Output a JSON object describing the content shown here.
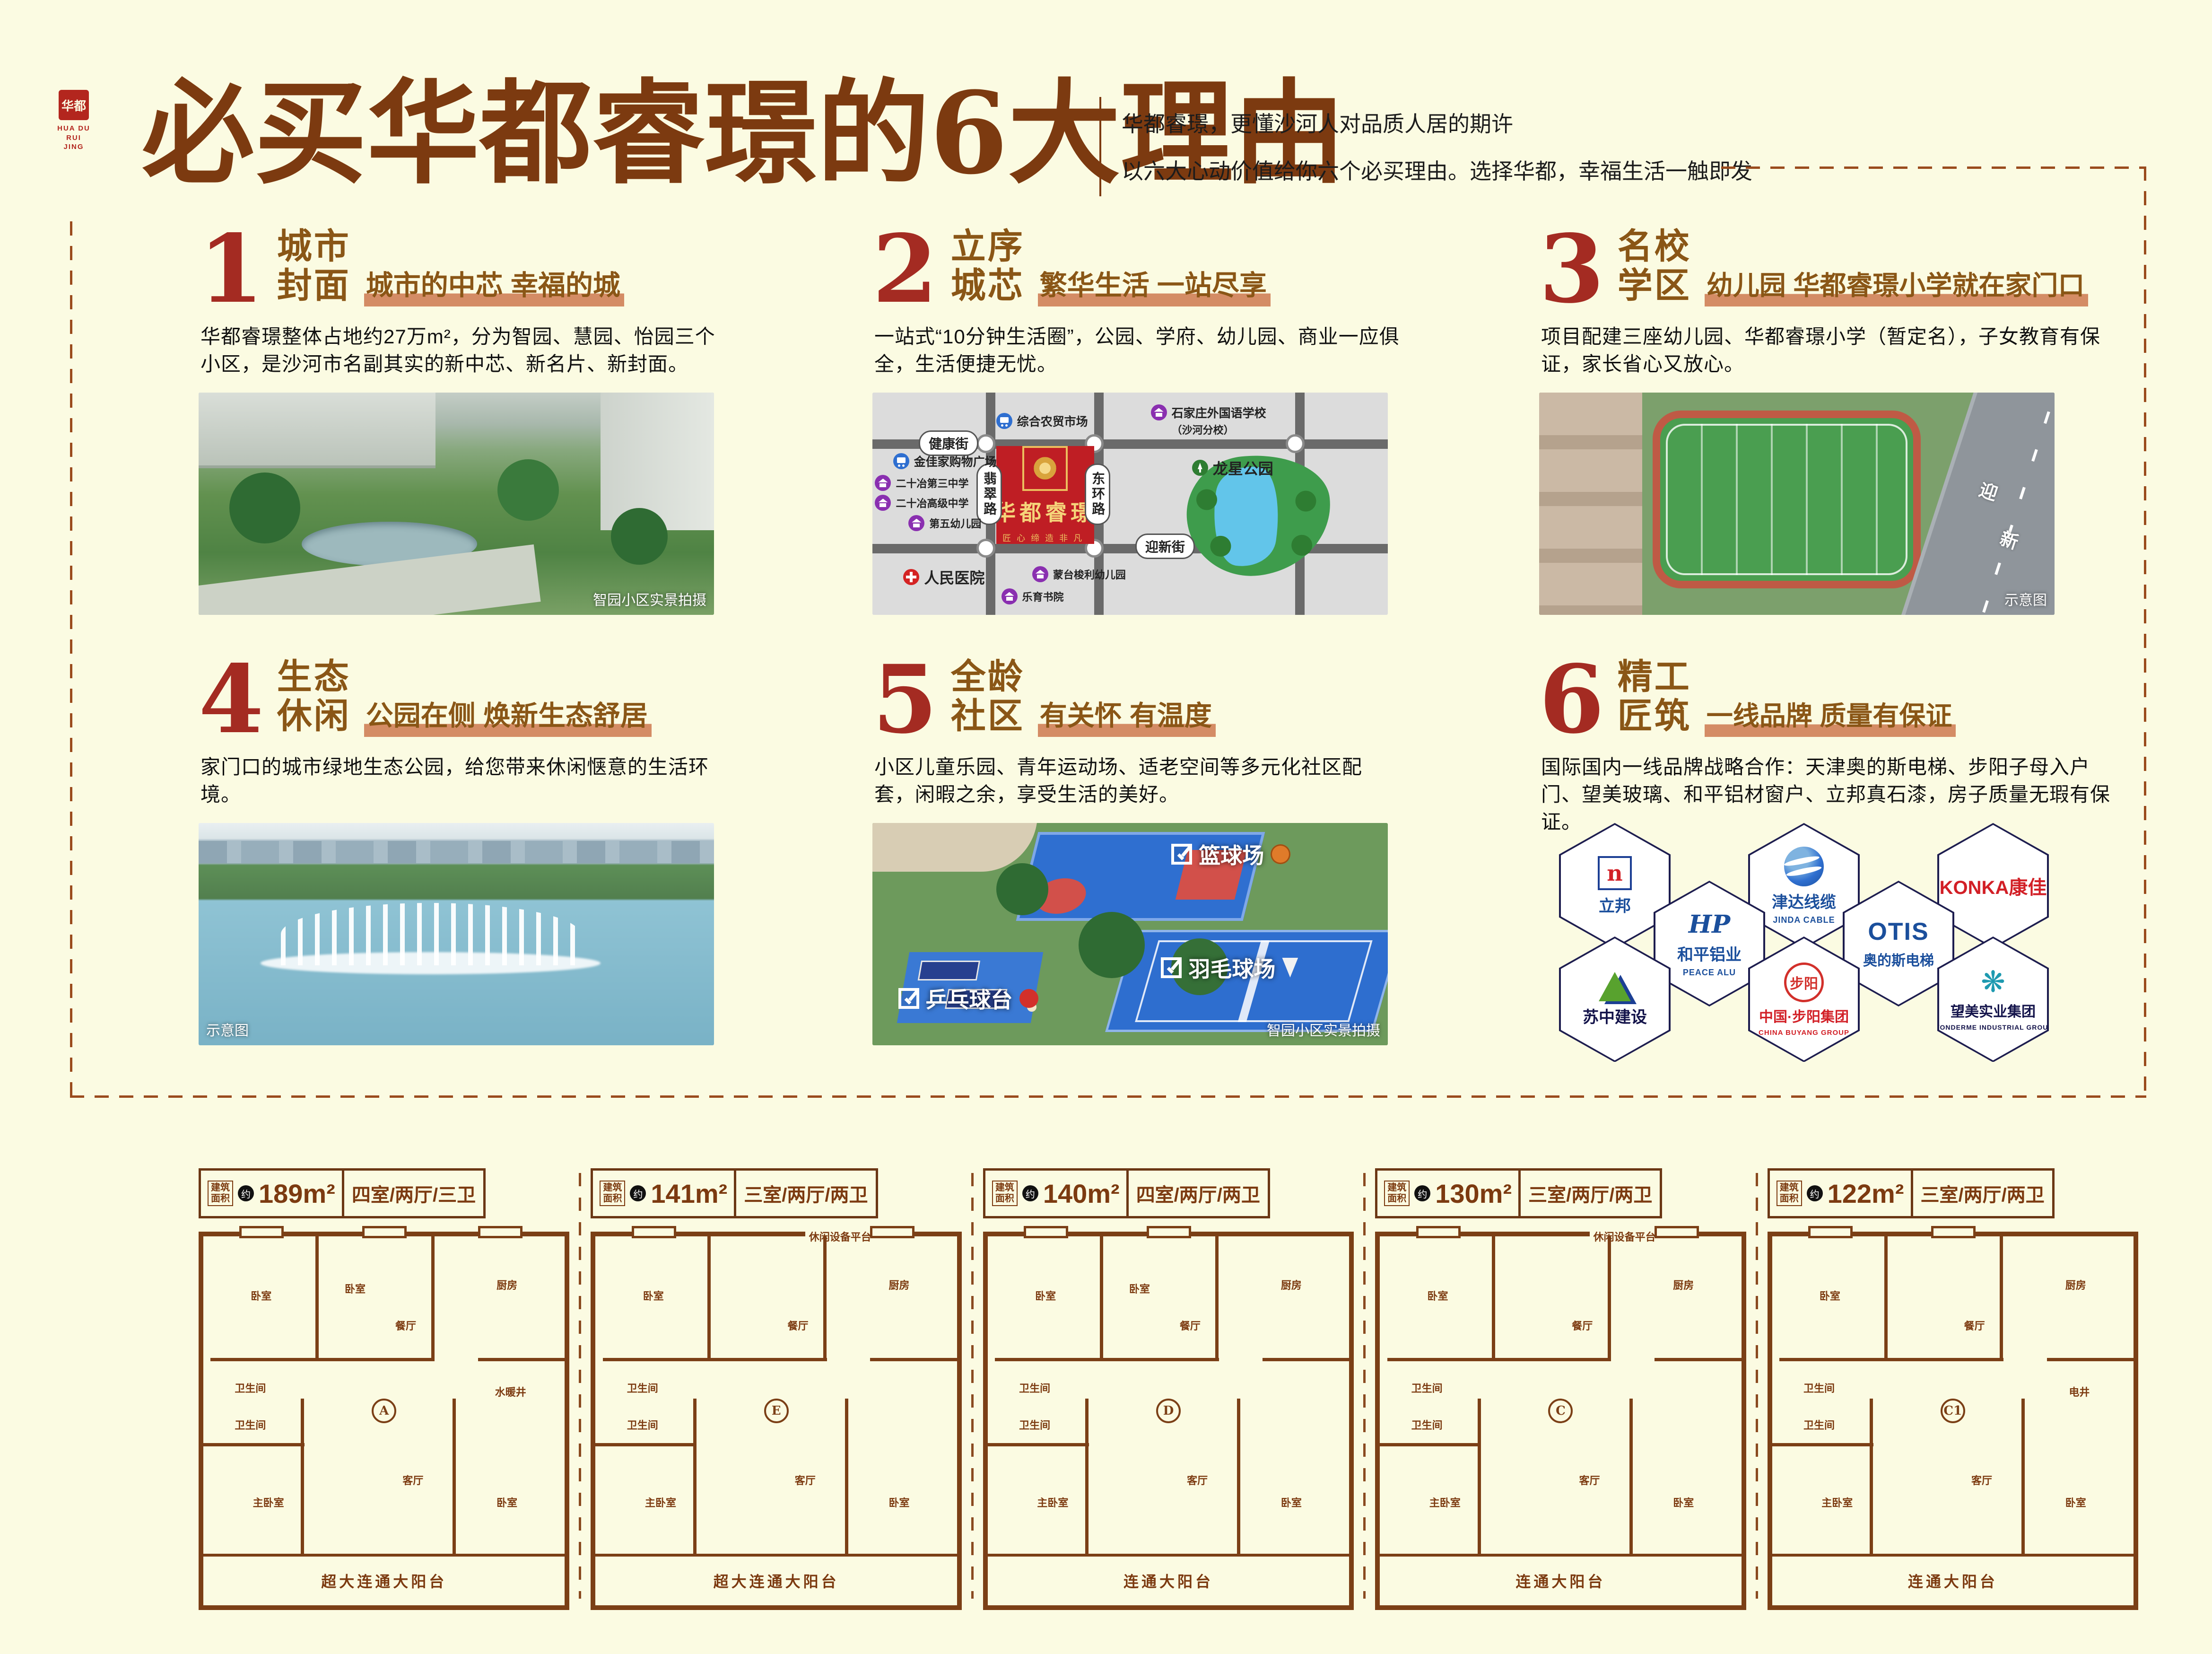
{
  "logo": {
    "seal": "华都",
    "en_line1": "HUA DU",
    "en_line2": "RUI JING"
  },
  "header": {
    "title": "必买华都睿璟的6大理由",
    "sub1": "华都睿璟，更懂沙河人对品质人居的期许",
    "sub2": "以六大心动价值给你六个必买理由。选择华都，幸福生活一触即发"
  },
  "reasons": [
    {
      "number": "1",
      "title1": "城市",
      "title2": "封面",
      "tagline": "城市的中芯 幸福的城",
      "body": "华都睿璟整体占地约27万m²，分为智园、慧园、怡园三个小区，是沙河市名副其实的新中芯、新名片、新封面。",
      "caption": "智园小区实景拍摄"
    },
    {
      "number": "2",
      "title1": "立序",
      "title2": "城芯",
      "tagline": "繁华生活 一站尽享",
      "body": "一站式“10分钟生活圈”，公园、学府、幼儿园、商业一应俱全，生活便捷无忧。"
    },
    {
      "number": "3",
      "title1": "名校",
      "title2": "学区",
      "tagline": "幼儿园 华都睿璟小学就在家门口",
      "body": "项目配建三座幼儿园、华都睿璟小学（暂定名），子女教育有保证，家长省心又放心。",
      "caption": "示意图",
      "road_char1": "迎",
      "road_char2": "新"
    },
    {
      "number": "4",
      "title1": "生态",
      "title2": "休闲",
      "tagline": "公园在侧 焕新生态舒居",
      "body": "家门口的城市绿地生态公园，给您带来休闲惬意的生活环境。",
      "caption": "示意图"
    },
    {
      "number": "5",
      "title1": "全龄",
      "title2": "社区",
      "tagline": "有关怀 有温度",
      "body": "小区儿童乐园、青年运动场、适老空间等多元化社区配套，闲暇之余，享受生活的美好。",
      "caption": "智园小区实景拍摄",
      "sports": [
        "篮球场",
        "羽毛球场",
        "乒乓球台"
      ]
    },
    {
      "number": "6",
      "title1": "精工",
      "title2": "匠筑",
      "tagline": "一线品牌 质量有保证",
      "body": "国际国内一线品牌战略合作：天津奥的斯电梯、步阳子母入户门、望美玻璃、和平铝材窗户、立邦真石漆，房子质量无瑕有保证。"
    }
  ],
  "map": {
    "name": "华都睿璟",
    "tagline": "匠心缔造非凡",
    "street_n": "健康街",
    "street_s": "迎新街",
    "road_w": "翡翠路",
    "road_e": "东环路",
    "pois": [
      {
        "t": "综合农贸市场"
      },
      {
        "t": "石家庄外国语学校",
        "t2": "（沙河分校）"
      },
      {
        "t": "金佳家购物广场"
      },
      {
        "t": "二十冶第三中学"
      },
      {
        "t": "二十冶高级中学"
      },
      {
        "t": "第五幼儿园"
      },
      {
        "t": "人民医院"
      },
      {
        "t": "蒙台梭利幼儿园"
      },
      {
        "t": "乐育书院"
      },
      {
        "t": "龙星公园"
      }
    ]
  },
  "brands": [
    {
      "main": "立邦",
      "icon": "n"
    },
    {
      "main": "津达线缆",
      "sub": "JINDA CABLE"
    },
    {
      "main": "KONKA康佳"
    },
    {
      "main": "和平铝业",
      "sub": "PEACE ALU",
      "icon": "HP"
    },
    {
      "main": "OTIS",
      "sub": "奥的斯电梯"
    },
    {
      "main": "苏中建设"
    },
    {
      "main": "中国·步阳集团",
      "sub": "CHINA BUYANG GROUP",
      "icon": "步阳"
    },
    {
      "main": "望美实业集团",
      "sub": "WONDERME INDUSTRIAL GROUP",
      "icon": "❋"
    }
  ],
  "fp": {
    "prefix": "建筑面积",
    "approx": "约"
  },
  "floorplans": [
    {
      "area": "189m²",
      "layout": "四室/两厅/三卫",
      "unit": "A",
      "balcony": "超大连通大阳台",
      "top_label": "",
      "rooms": [
        "卧室",
        "卧室",
        "餐厅",
        "厨房",
        "卫生间",
        "卫生间",
        "主卧室",
        "客厅",
        "卧室",
        "水暖井"
      ]
    },
    {
      "area": "141m²",
      "layout": "三室/两厅/两卫",
      "unit": "E",
      "balcony": "超大连通大阳台",
      "top_label": "休闲设备平台",
      "rooms": [
        "卧室",
        "",
        "餐厅",
        "厨房",
        "卫生间",
        "卫生间",
        "主卧室",
        "客厅",
        "卧室",
        ""
      ]
    },
    {
      "area": "140m²",
      "layout": "四室/两厅/两卫",
      "unit": "D",
      "balcony": "连通大阳台",
      "top_label": "",
      "rooms": [
        "卧室",
        "卧室",
        "餐厅",
        "厨房",
        "卫生间",
        "卫生间",
        "主卧室",
        "客厅",
        "卧室",
        ""
      ]
    },
    {
      "area": "130m²",
      "layout": "三室/两厅/两卫",
      "unit": "C",
      "balcony": "连通大阳台",
      "top_label": "休闲设备平台",
      "rooms": [
        "卧室",
        "",
        "餐厅",
        "厨房",
        "卫生间",
        "卫生间",
        "主卧室",
        "客厅",
        "卧室",
        ""
      ]
    },
    {
      "area": "122m²",
      "layout": "三室/两厅/两卫",
      "unit": "C1",
      "balcony": "连通大阳台",
      "top_label": "",
      "rooms": [
        "卧室",
        "",
        "餐厅",
        "厨房",
        "卫生间",
        "卫生间",
        "主卧室",
        "客厅",
        "卧室",
        "电井"
      ]
    }
  ]
}
